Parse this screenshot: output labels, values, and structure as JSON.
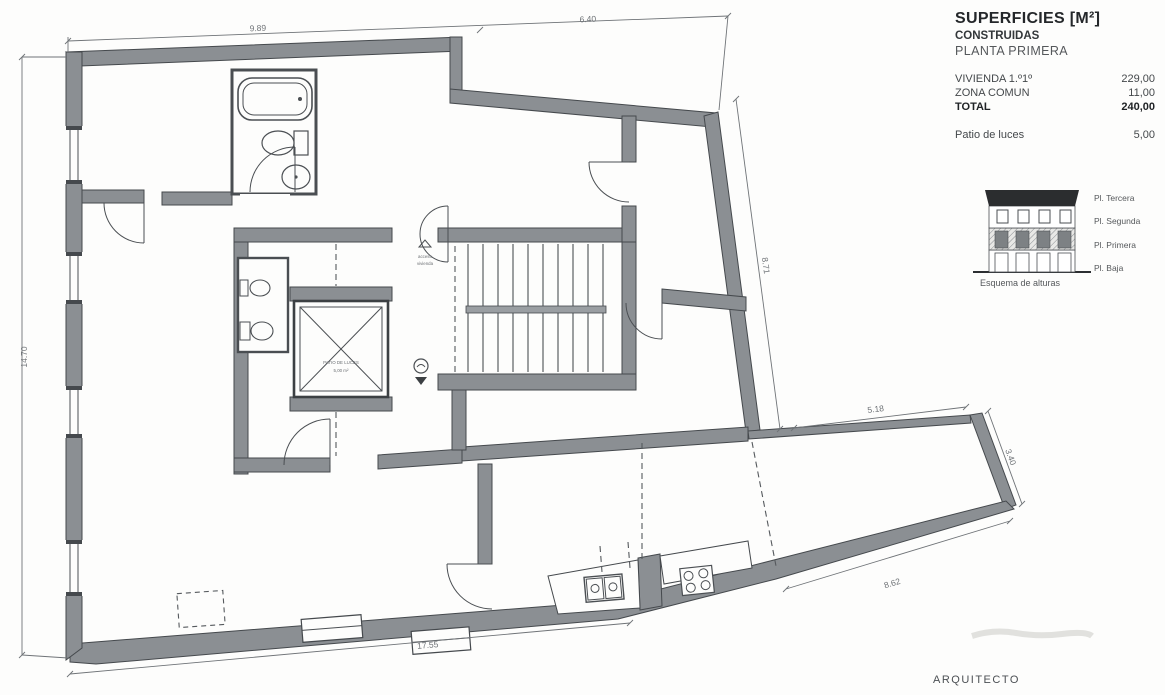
{
  "colors": {
    "wall_fill": "#8b8f93",
    "wall_stroke": "#45494d",
    "line": "#4b4f53",
    "dashed": "#55595d",
    "roof": "#2b2d2f",
    "dim_text": "#6f7377",
    "background": "#fdfdfc"
  },
  "panel": {
    "title": "SUPERFICIES [M²]",
    "line2": "CONSTRUIDAS",
    "line3": "PLANTA PRIMERA",
    "table": {
      "rows": [
        {
          "label": "VIVIENDA 1.º1º",
          "value": "229,00"
        },
        {
          "label": "ZONA COMUN",
          "value": "11,00"
        },
        {
          "label": "TOTAL",
          "value": "240,00"
        }
      ],
      "patio_label": "Patio de luces",
      "patio_value": "5,00"
    },
    "elevation": {
      "floors": [
        "Pl. Tercera",
        "Pl. Segunda",
        "Pl. Primera",
        "Pl. Baja"
      ],
      "caption": "Esquema de alturas"
    }
  },
  "plan": {
    "dims": {
      "top_left": "9.89",
      "top_right": "6.40",
      "left": "14.70",
      "right_upper": "8.71",
      "wing_top": "5.18",
      "wing_right": "3.40",
      "wing_bottom": "8.62",
      "bottom": "17.55"
    },
    "labels": {
      "patio_line1": "PATIO DE LUCES",
      "patio_line2": "5,00 m²",
      "access_line1": "acceso",
      "access_line2": "vivienda"
    }
  },
  "footer": {
    "architect": "ARQUITECTO"
  }
}
